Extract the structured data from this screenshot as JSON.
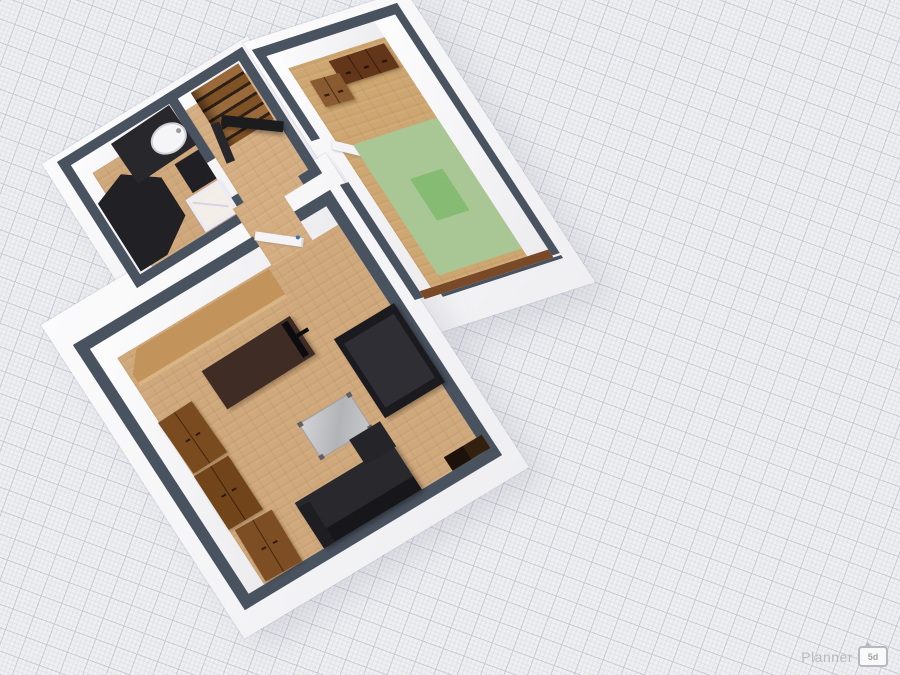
{
  "watermark": {
    "brand": "Planner",
    "badge_label": "5d"
  },
  "canvas": {
    "view": "3d-floorplan-perspective",
    "background_color": "#eeeff1",
    "grid": {
      "angle_deg": 20,
      "minor_step_px": 4.4,
      "major_step_px": 22,
      "minor_color": "#d6d6e2",
      "major_color": "#c6c6d4"
    }
  },
  "palette": {
    "wall_top": "#49525f",
    "wall_inner_face": "#f2f2f4",
    "floor_wood": "#cfa87b",
    "floor_wood_light": "#d4ae82",
    "floor_wood_dark": "#cda671",
    "floor_slab_edge": "#7a4a28",
    "rug_green": "#a9c795",
    "rug_green_center": "#85bb72",
    "black_furniture": "#212125",
    "cabinet_brown_dark": "#63361a",
    "cabinet_brown_mid": "#7b4b20",
    "desk_espresso": "#3f2d25",
    "counter_tan": "#c2945c",
    "coffee_table_silver": "#c0c1c4",
    "stair_wood": "#8f5f30",
    "door_handle_blue": "#3a72b0"
  },
  "floorplan": {
    "rooms": [
      {
        "name": "bathroom",
        "furniture": [
          "bathtub",
          "vanity-counter",
          "sink",
          "base-cabinet",
          "drying-rack"
        ]
      },
      {
        "name": "stair-hall",
        "furniture": [
          "staircase",
          "open-door-black"
        ]
      },
      {
        "name": "bedroom",
        "furniture": [
          "dresser-dark",
          "dresser-light",
          "open-door-white",
          "green-rug"
        ]
      },
      {
        "name": "living-room",
        "furniture": [
          "kitchen-counter",
          "desk",
          "tv-flatscreen",
          "wardrobe-1",
          "wardrobe-2",
          "wardrobe-3",
          "coffee-table",
          "bed",
          "sofa",
          "corner-media-unit",
          "open-door-white"
        ]
      }
    ]
  }
}
